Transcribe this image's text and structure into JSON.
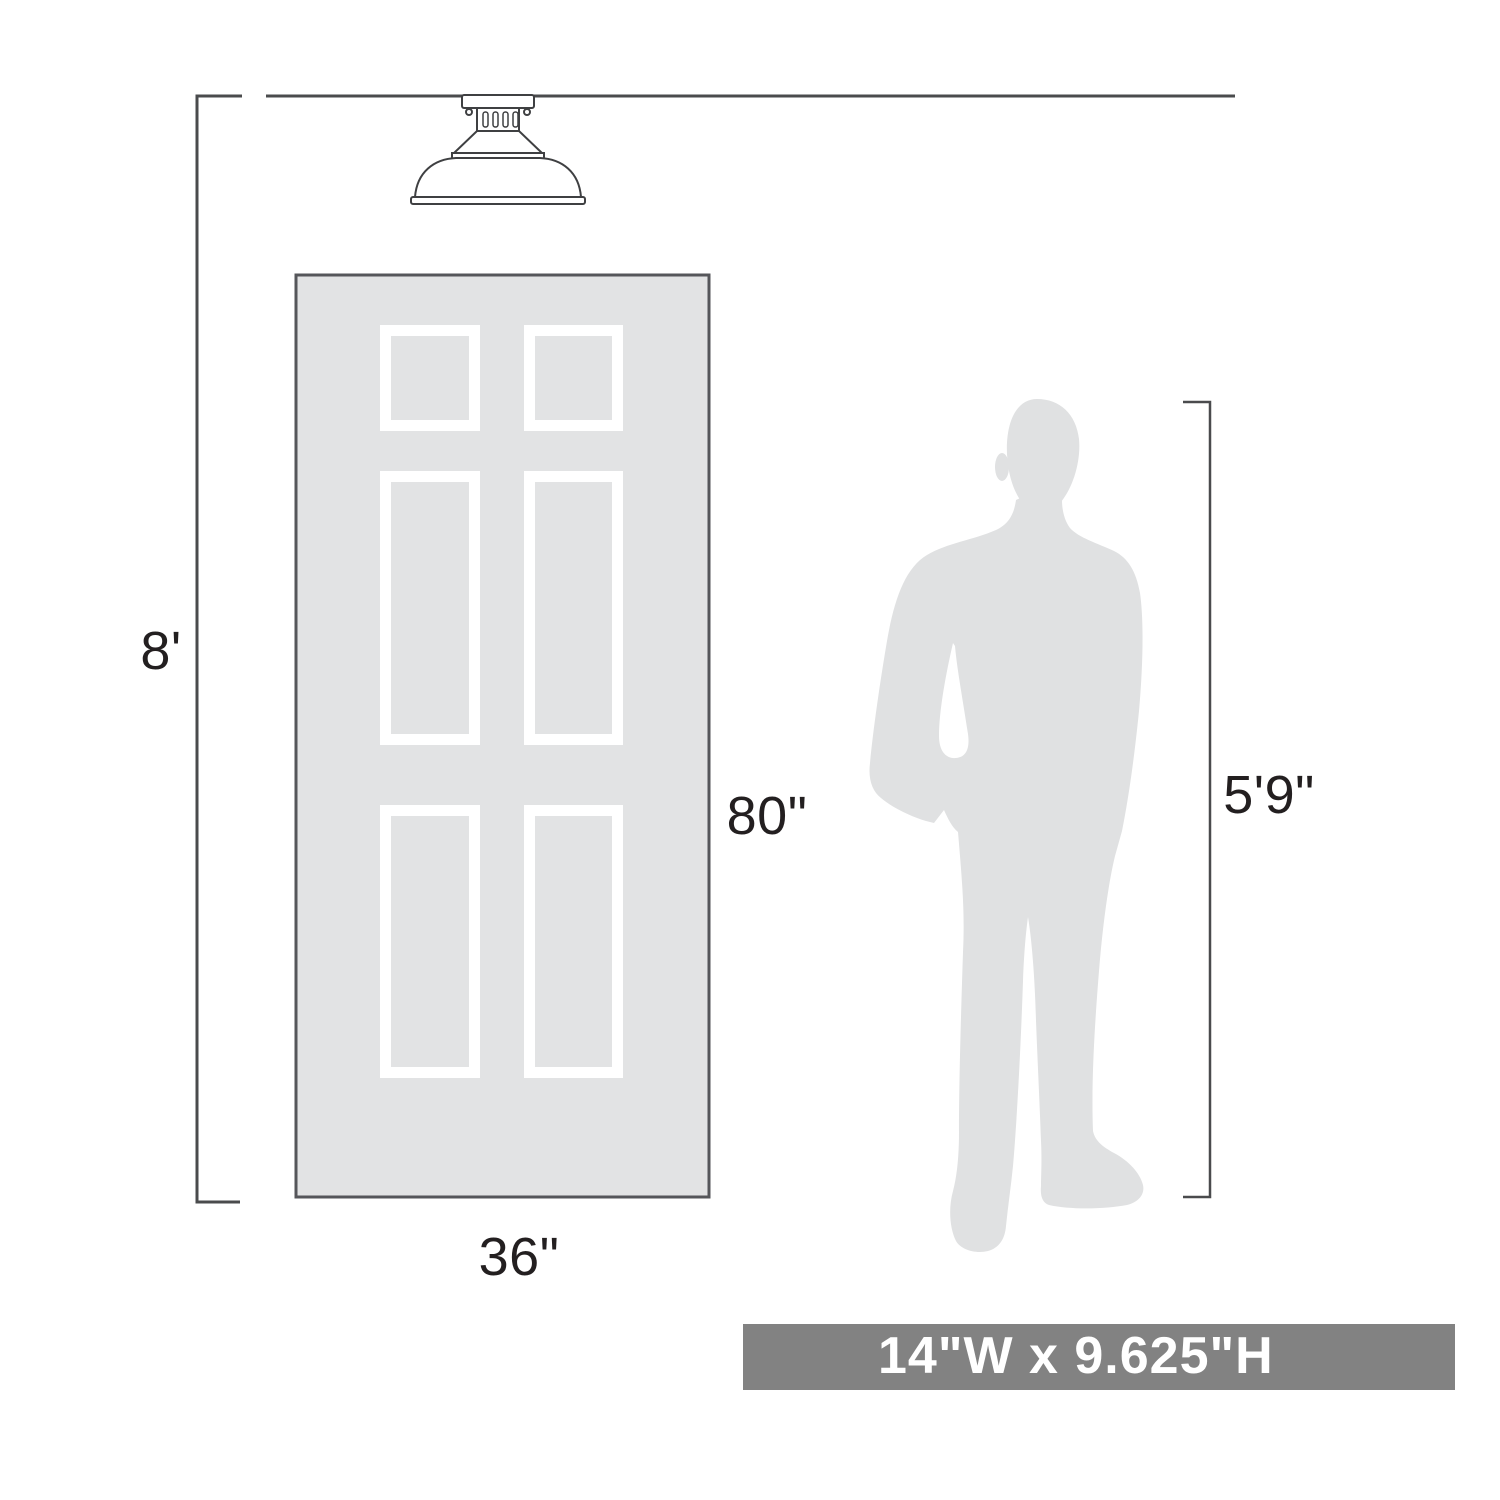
{
  "diagram": {
    "labels": {
      "ceiling_height": "8'",
      "door_height": "80\"",
      "door_width": "36\"",
      "person_height": "5'9\""
    },
    "banner": {
      "text": "14\"W x 9.625\"H"
    },
    "figures": {
      "fixture": "semi-flush-ceiling-light",
      "door": "six-panel-door",
      "person": "standing-man-silhouette"
    },
    "colors": {
      "line": "#4a4b4d",
      "text": "#231f20",
      "door_fill": "#e2e3e4",
      "door_border": "#55565a",
      "panel_frame": "#ffffff",
      "person_fill": "#e0e1e2",
      "banner_bg": "#828282",
      "banner_text": "#ffffff",
      "fixture_line": "#3f4042"
    }
  }
}
